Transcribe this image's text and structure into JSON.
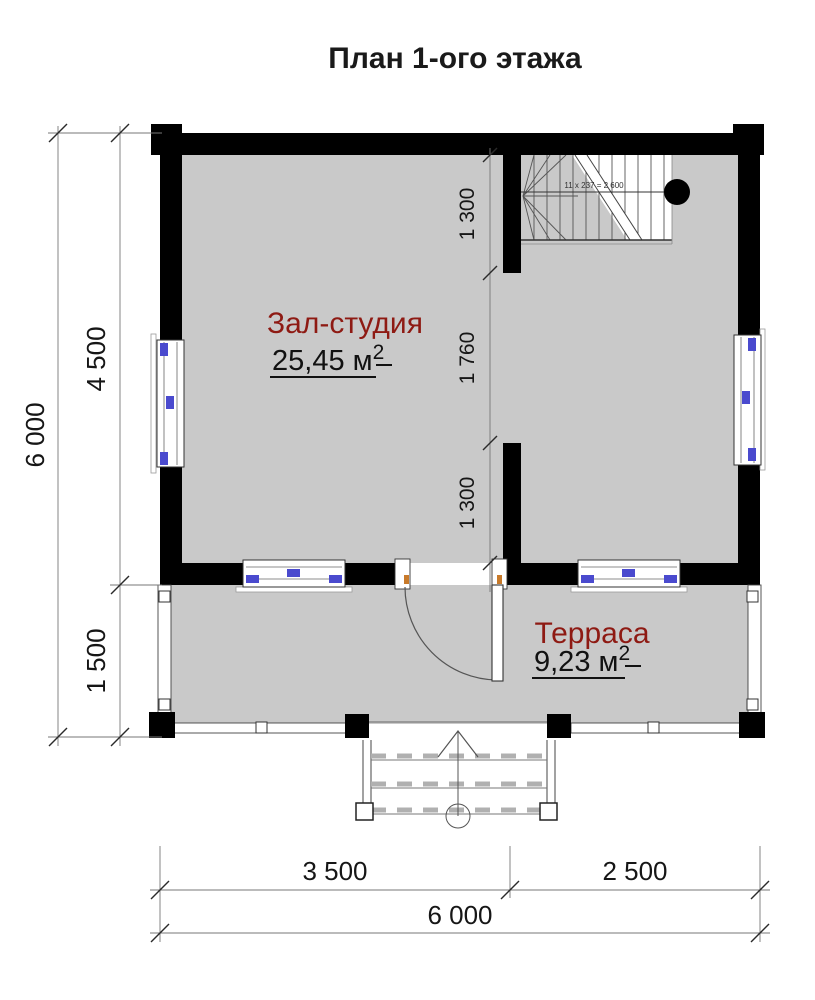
{
  "title": "План 1-ого этажа",
  "rooms": {
    "hall": {
      "name": "Зал-студия",
      "area": "25,45 м",
      "area_sup": "2"
    },
    "terrace": {
      "name": "Терраса",
      "area": "9,23 м",
      "area_sup": "2"
    }
  },
  "dimensions": {
    "left_total": "6 000",
    "left_upper": "4 500",
    "left_lower": "1 500",
    "mid_upper": "1 300",
    "mid_middle": "1 760",
    "mid_lower": "1 300",
    "bottom_left": "3 500",
    "bottom_right": "2 500",
    "bottom_total": "6 000"
  },
  "stairs": {
    "annotation": "11 x 237 = 2 600"
  },
  "colors": {
    "wall": "#000000",
    "floor": "#c9c9c9",
    "room_label": "#8e1a13",
    "window_mark": "#4a4ace",
    "hinge_mark": "#c87a2a"
  }
}
